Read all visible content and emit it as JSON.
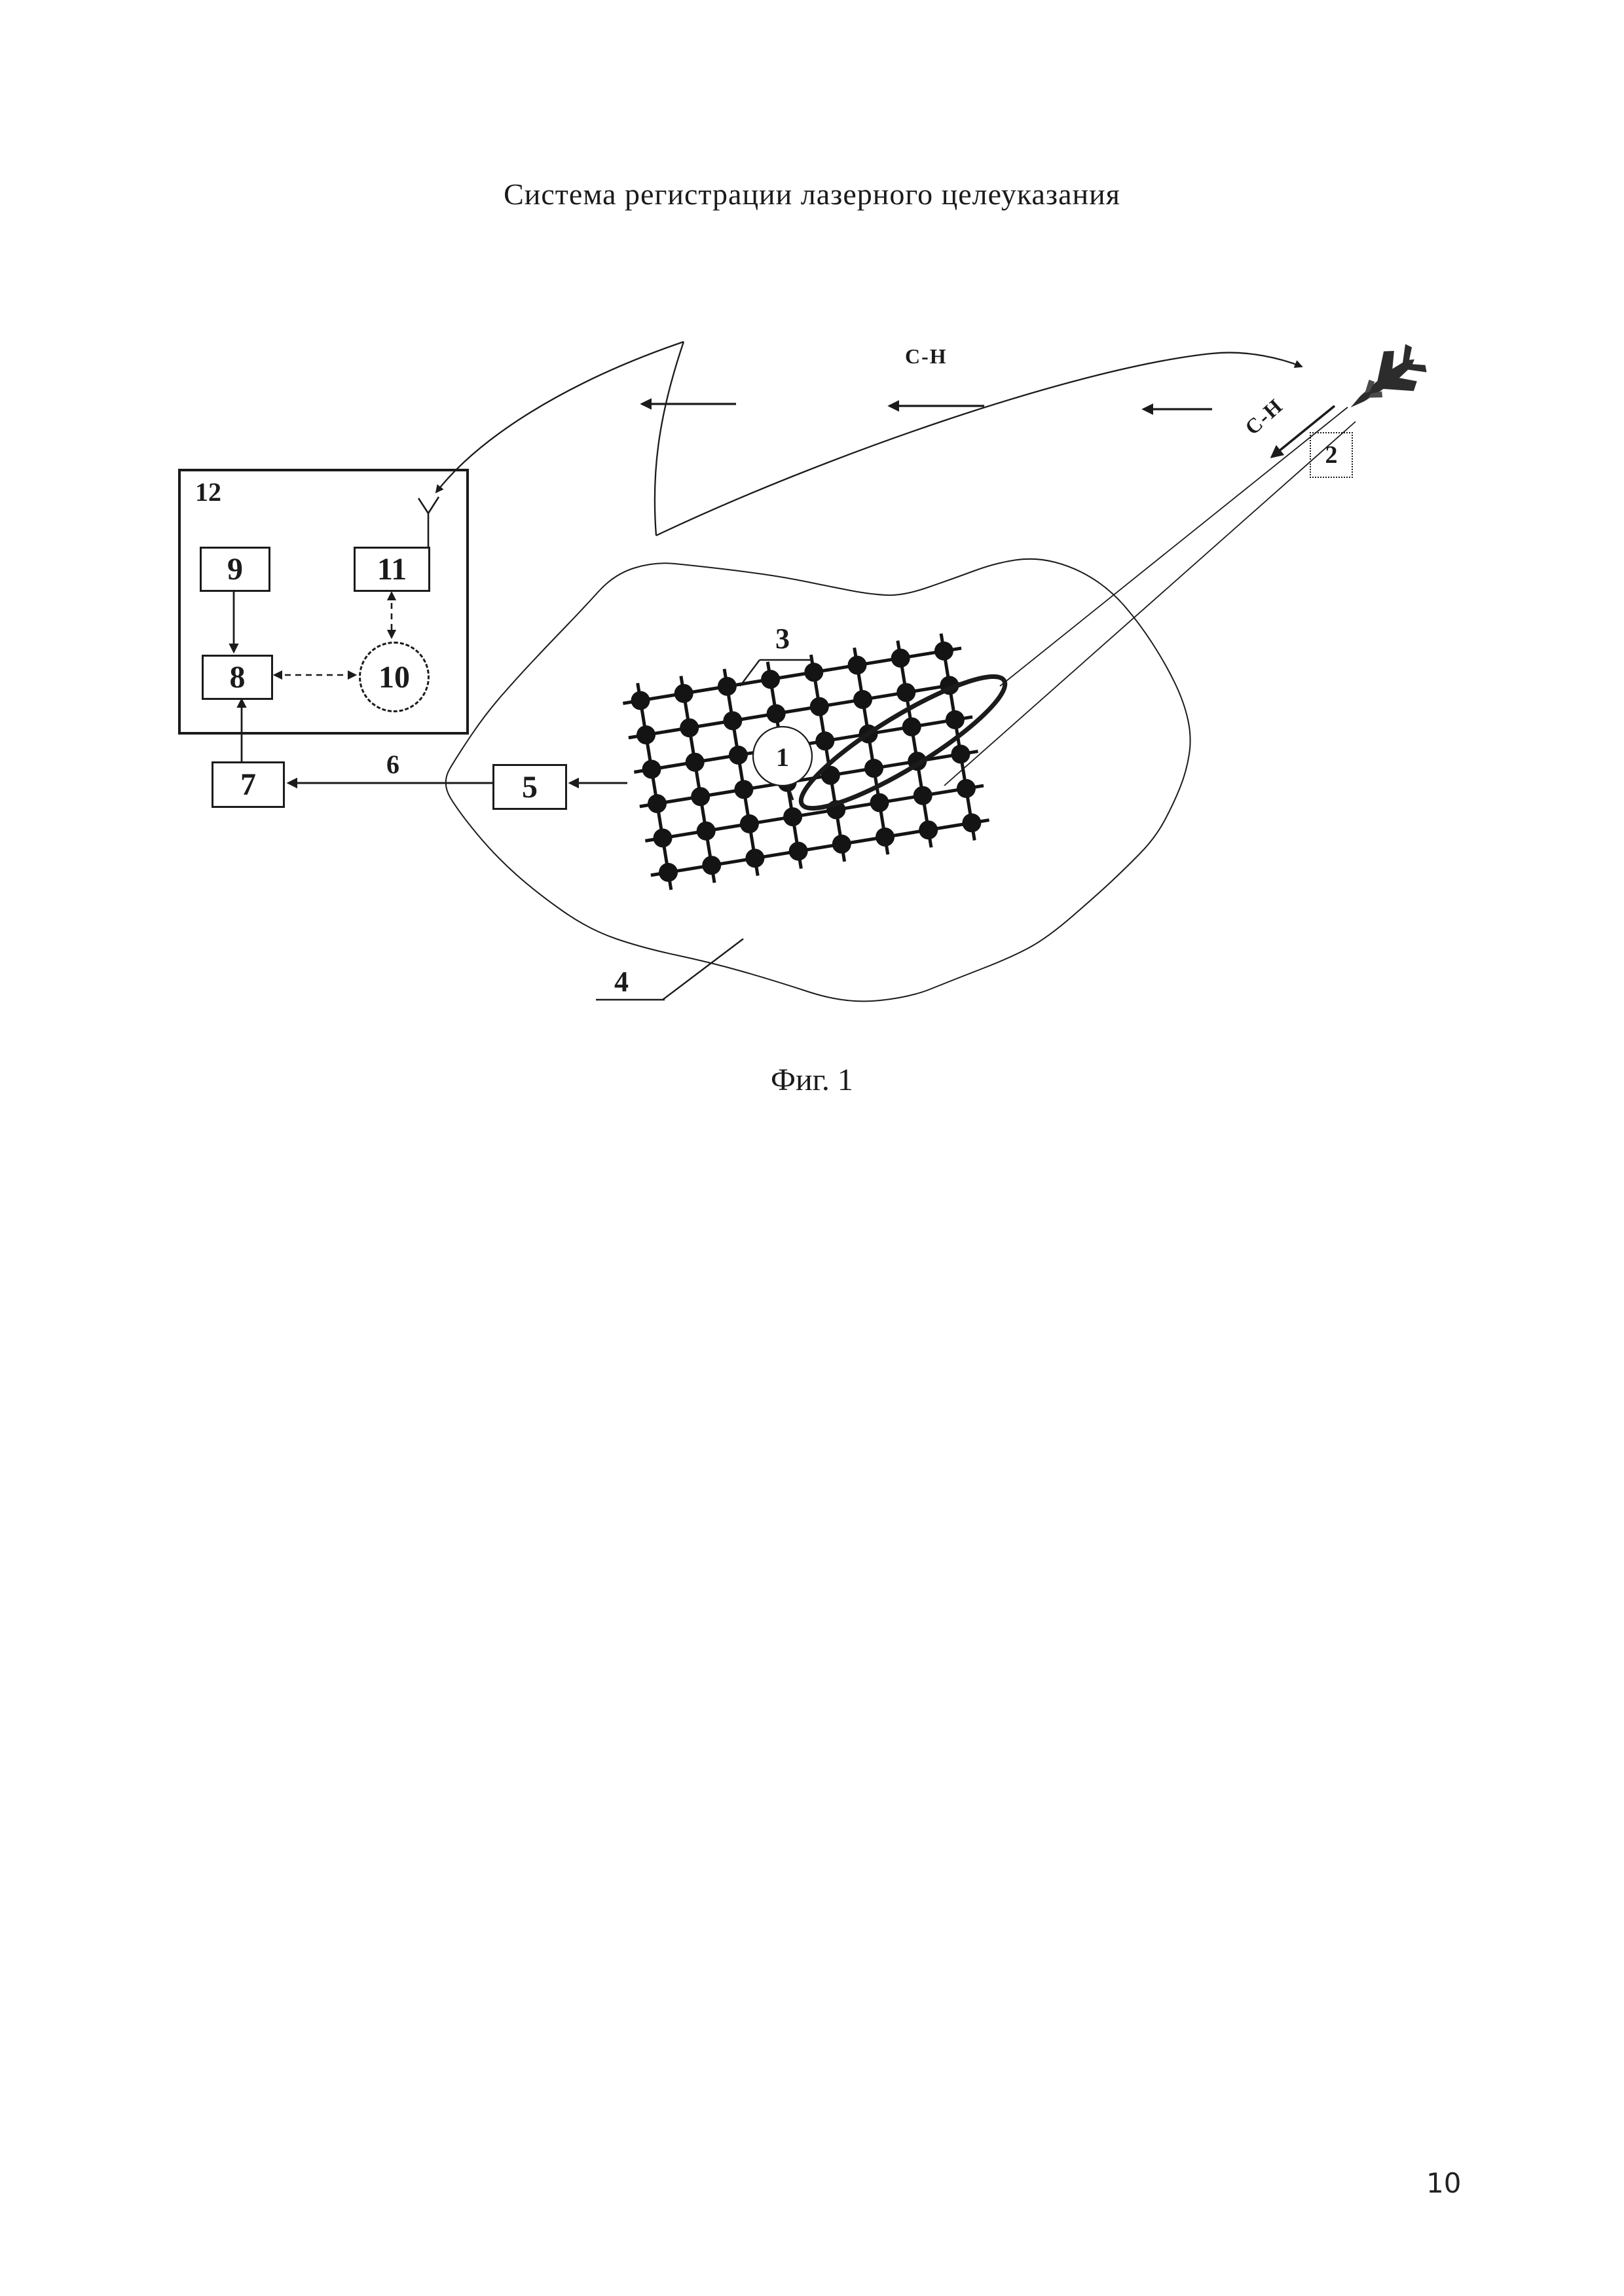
{
  "page": {
    "title": "Система регистрации лазерного целеуказания",
    "figure_caption": "Фиг. 1",
    "page_number": "10"
  },
  "diagram": {
    "signal_top_label": "С-Н",
    "signal_beam_label": "С-Н",
    "node_labels": {
      "n1": "1",
      "n2": "2",
      "n3": "3",
      "n4": "4",
      "n5": "5",
      "n6": "6",
      "n7": "7",
      "n8": "8",
      "n9": "9",
      "n10": "10",
      "n11": "11",
      "n12": "12"
    },
    "sensor_grid": {
      "rows": 6,
      "cols": 8
    }
  }
}
